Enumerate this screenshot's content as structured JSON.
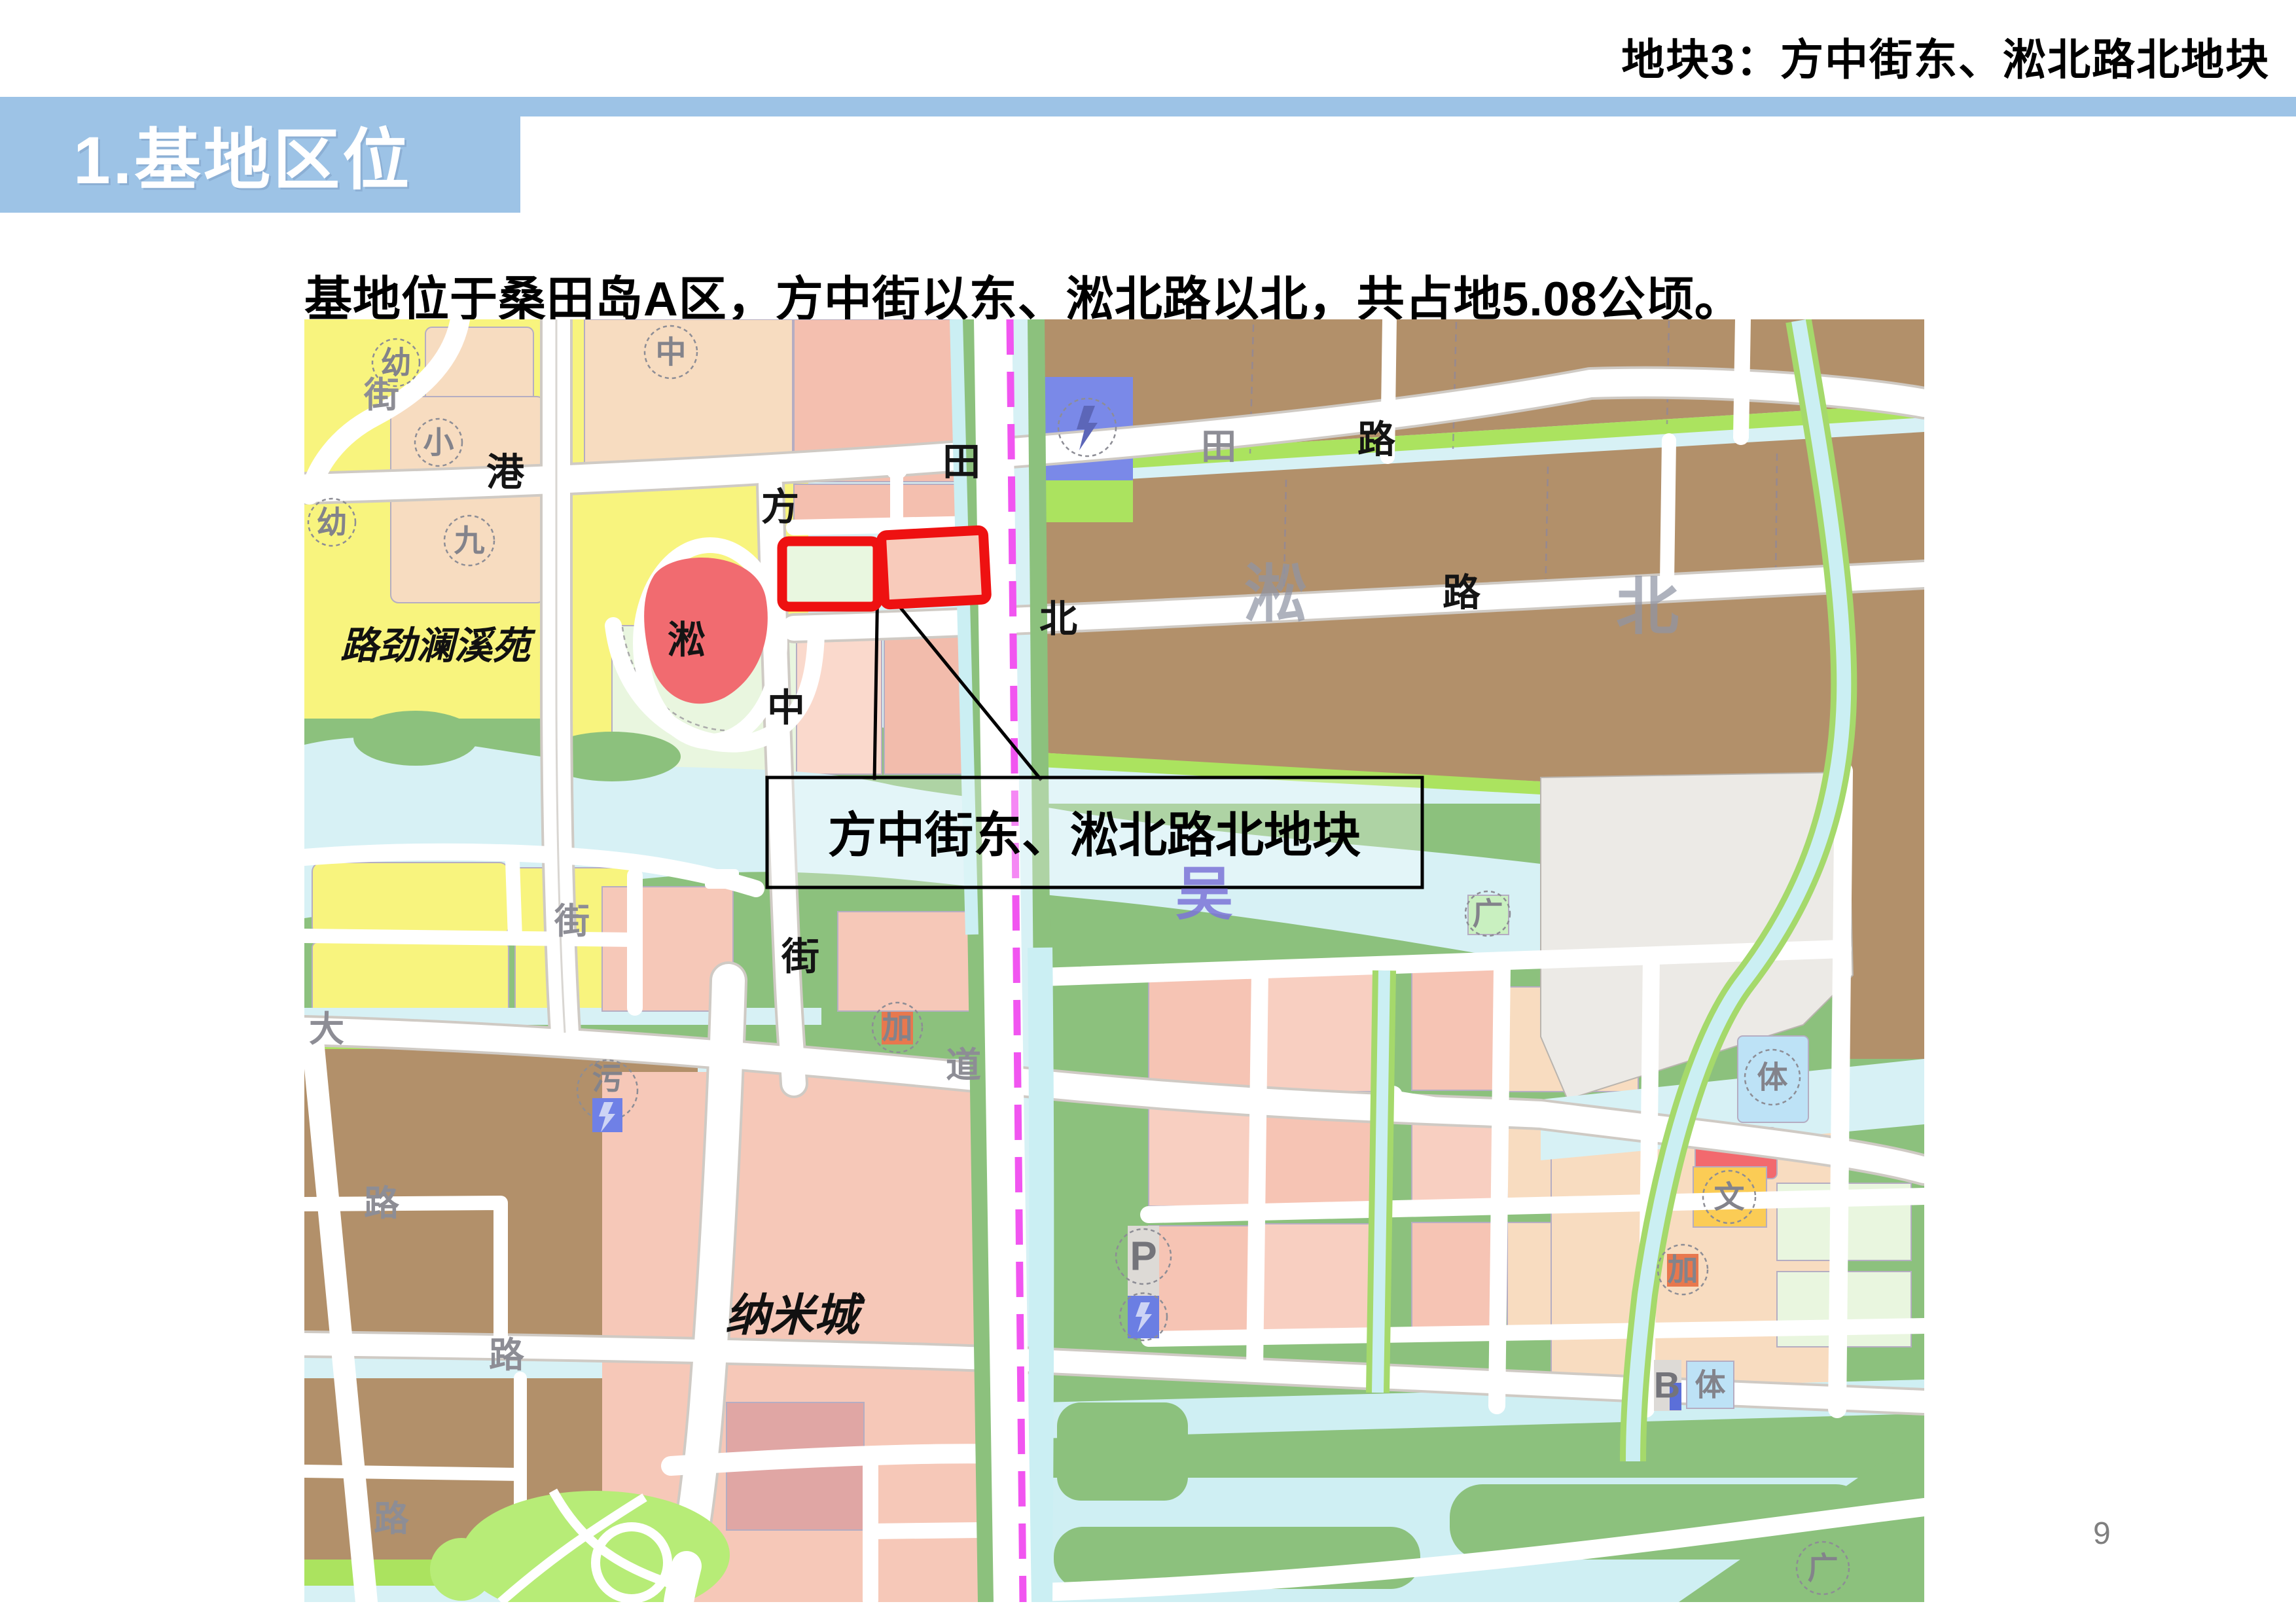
{
  "header": {
    "title": "地块3：方中街东、淞北路北地块"
  },
  "banner": {
    "label": "1.基地区位"
  },
  "body": {
    "description": "基地位于桑田岛A区，方中街以东、淞北路以北，共占地5.08公顷。"
  },
  "map": {
    "callout": {
      "label": "方中街东、淞北路北地块"
    },
    "labels": {
      "kindergarten_nw": "幼",
      "street_nw": "街",
      "primary_school": "小",
      "gang_road": "港",
      "nine_circle": "九",
      "kindergarten_w": "幼",
      "lujin_lanxiyuan": "路劲澜溪苑",
      "zhong_circle": "中",
      "fang_street": "方",
      "song_w": "淞",
      "zhong_street": "中",
      "jie_street": "街",
      "tian_e": "田",
      "tian_gray": "田",
      "lu_ne": "路",
      "bei_road": "北",
      "song_watermark": "淞",
      "lu_e": "路",
      "bei_watermark": "北",
      "wu_river": "吴",
      "jie_w": "街",
      "da_avenue": "大",
      "dao_avenue": "道",
      "lu_sw1": "路",
      "lu_sw2": "路",
      "lu_sw3": "路",
      "nami_city": "纳米城",
      "sewage_plant": "污",
      "gas_station_w": "加",
      "plaza_n": "广",
      "sports_n": "体",
      "culture": "文",
      "gas_station_e": "加",
      "bus_b": "B",
      "sports_s": "体",
      "plaza_s": "广",
      "parking": "P"
    },
    "colors": {
      "accent_blue": "#9DC3E6",
      "site_outline_red": "#EE1111",
      "water_cyan": "#D7F1F5",
      "park_green": "#8CC17D",
      "industrial_brown": "#B2906A",
      "residential_pink": "#F6C4B4",
      "village_yellow": "#F8F47E",
      "metro_magenta": "#F155F0"
    }
  },
  "footer": {
    "page_number": "9"
  }
}
